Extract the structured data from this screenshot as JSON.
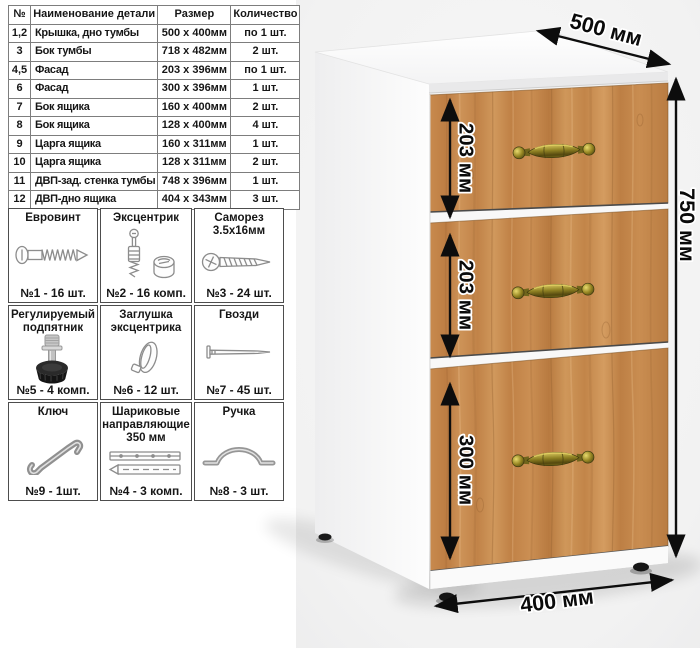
{
  "parts_table": {
    "headers": {
      "num": "№",
      "name": "Наименование детали",
      "size": "Размер",
      "qty": "Количество"
    },
    "rows": [
      {
        "num": "1,2",
        "name": "Крышка, дно тумбы",
        "size": "500 х 400мм",
        "qty": "по 1 шт."
      },
      {
        "num": "3",
        "name": "Бок тумбы",
        "size": "718 х 482мм",
        "qty": "2 шт."
      },
      {
        "num": "4,5",
        "name": "Фасад",
        "size": "203 х 396мм",
        "qty": "по 1 шт."
      },
      {
        "num": "6",
        "name": "Фасад",
        "size": "300 х 396мм",
        "qty": "1 шт."
      },
      {
        "num": "7",
        "name": "Бок ящика",
        "size": "160 х 400мм",
        "qty": "2 шт."
      },
      {
        "num": "8",
        "name": "Бок ящика",
        "size": "128 х 400мм",
        "qty": "4 шт."
      },
      {
        "num": "9",
        "name": "Царга ящика",
        "size": "160 х 311мм",
        "qty": "1 шт."
      },
      {
        "num": "10",
        "name": "Царга ящика",
        "size": "128 х 311мм",
        "qty": "2 шт."
      },
      {
        "num": "11",
        "name": "ДВП-зад. стенка тумбы",
        "size": "748 х 396мм",
        "qty": "1 шт."
      },
      {
        "num": "12",
        "name": "ДВП-дно ящика",
        "size": "404 х 343мм",
        "qty": "3 шт."
      }
    ]
  },
  "hardware": {
    "cells": [
      {
        "title": "Евровинт",
        "count": "№1 - 16 шт.",
        "icon": "euro-screw"
      },
      {
        "title": "Эксцентрик",
        "count": "№2 - 16 комп.",
        "icon": "cam-lock"
      },
      {
        "title": "Саморез 3.5х16мм",
        "count": "№3 - 24 шт.",
        "icon": "self-tapping-screw"
      },
      {
        "title": "Регулируемый подпятник",
        "count": "№5 - 4 комп.",
        "icon": "adjustable-foot"
      },
      {
        "title": "Заглушка эксцентрика",
        "count": "№6 - 12 шт.",
        "icon": "cam-cap"
      },
      {
        "title": "Гвозди",
        "count": "№7 - 45 шт.",
        "icon": "nail"
      },
      {
        "title": "Ключ",
        "count": "№9 - 1шт.",
        "icon": "hex-key"
      },
      {
        "title": "Шариковые направляющие 350 мм",
        "count": "№4 - 3 комп.",
        "icon": "ball-bearing-slides"
      },
      {
        "title": "Ручка",
        "count": "№8 - 3 шт.",
        "icon": "handle"
      }
    ]
  },
  "dimensions": {
    "depth": "500 мм",
    "height": "750 мм",
    "width": "400 мм",
    "drawer_top": "203 мм",
    "drawer_middle": "203 мм",
    "drawer_bottom": "300 мм"
  },
  "colors": {
    "wood": "#c78a4e",
    "handle_brass": "#8d7f22",
    "dimension_text": "#0d0d0d",
    "backdrop": "#f2f2f2"
  }
}
